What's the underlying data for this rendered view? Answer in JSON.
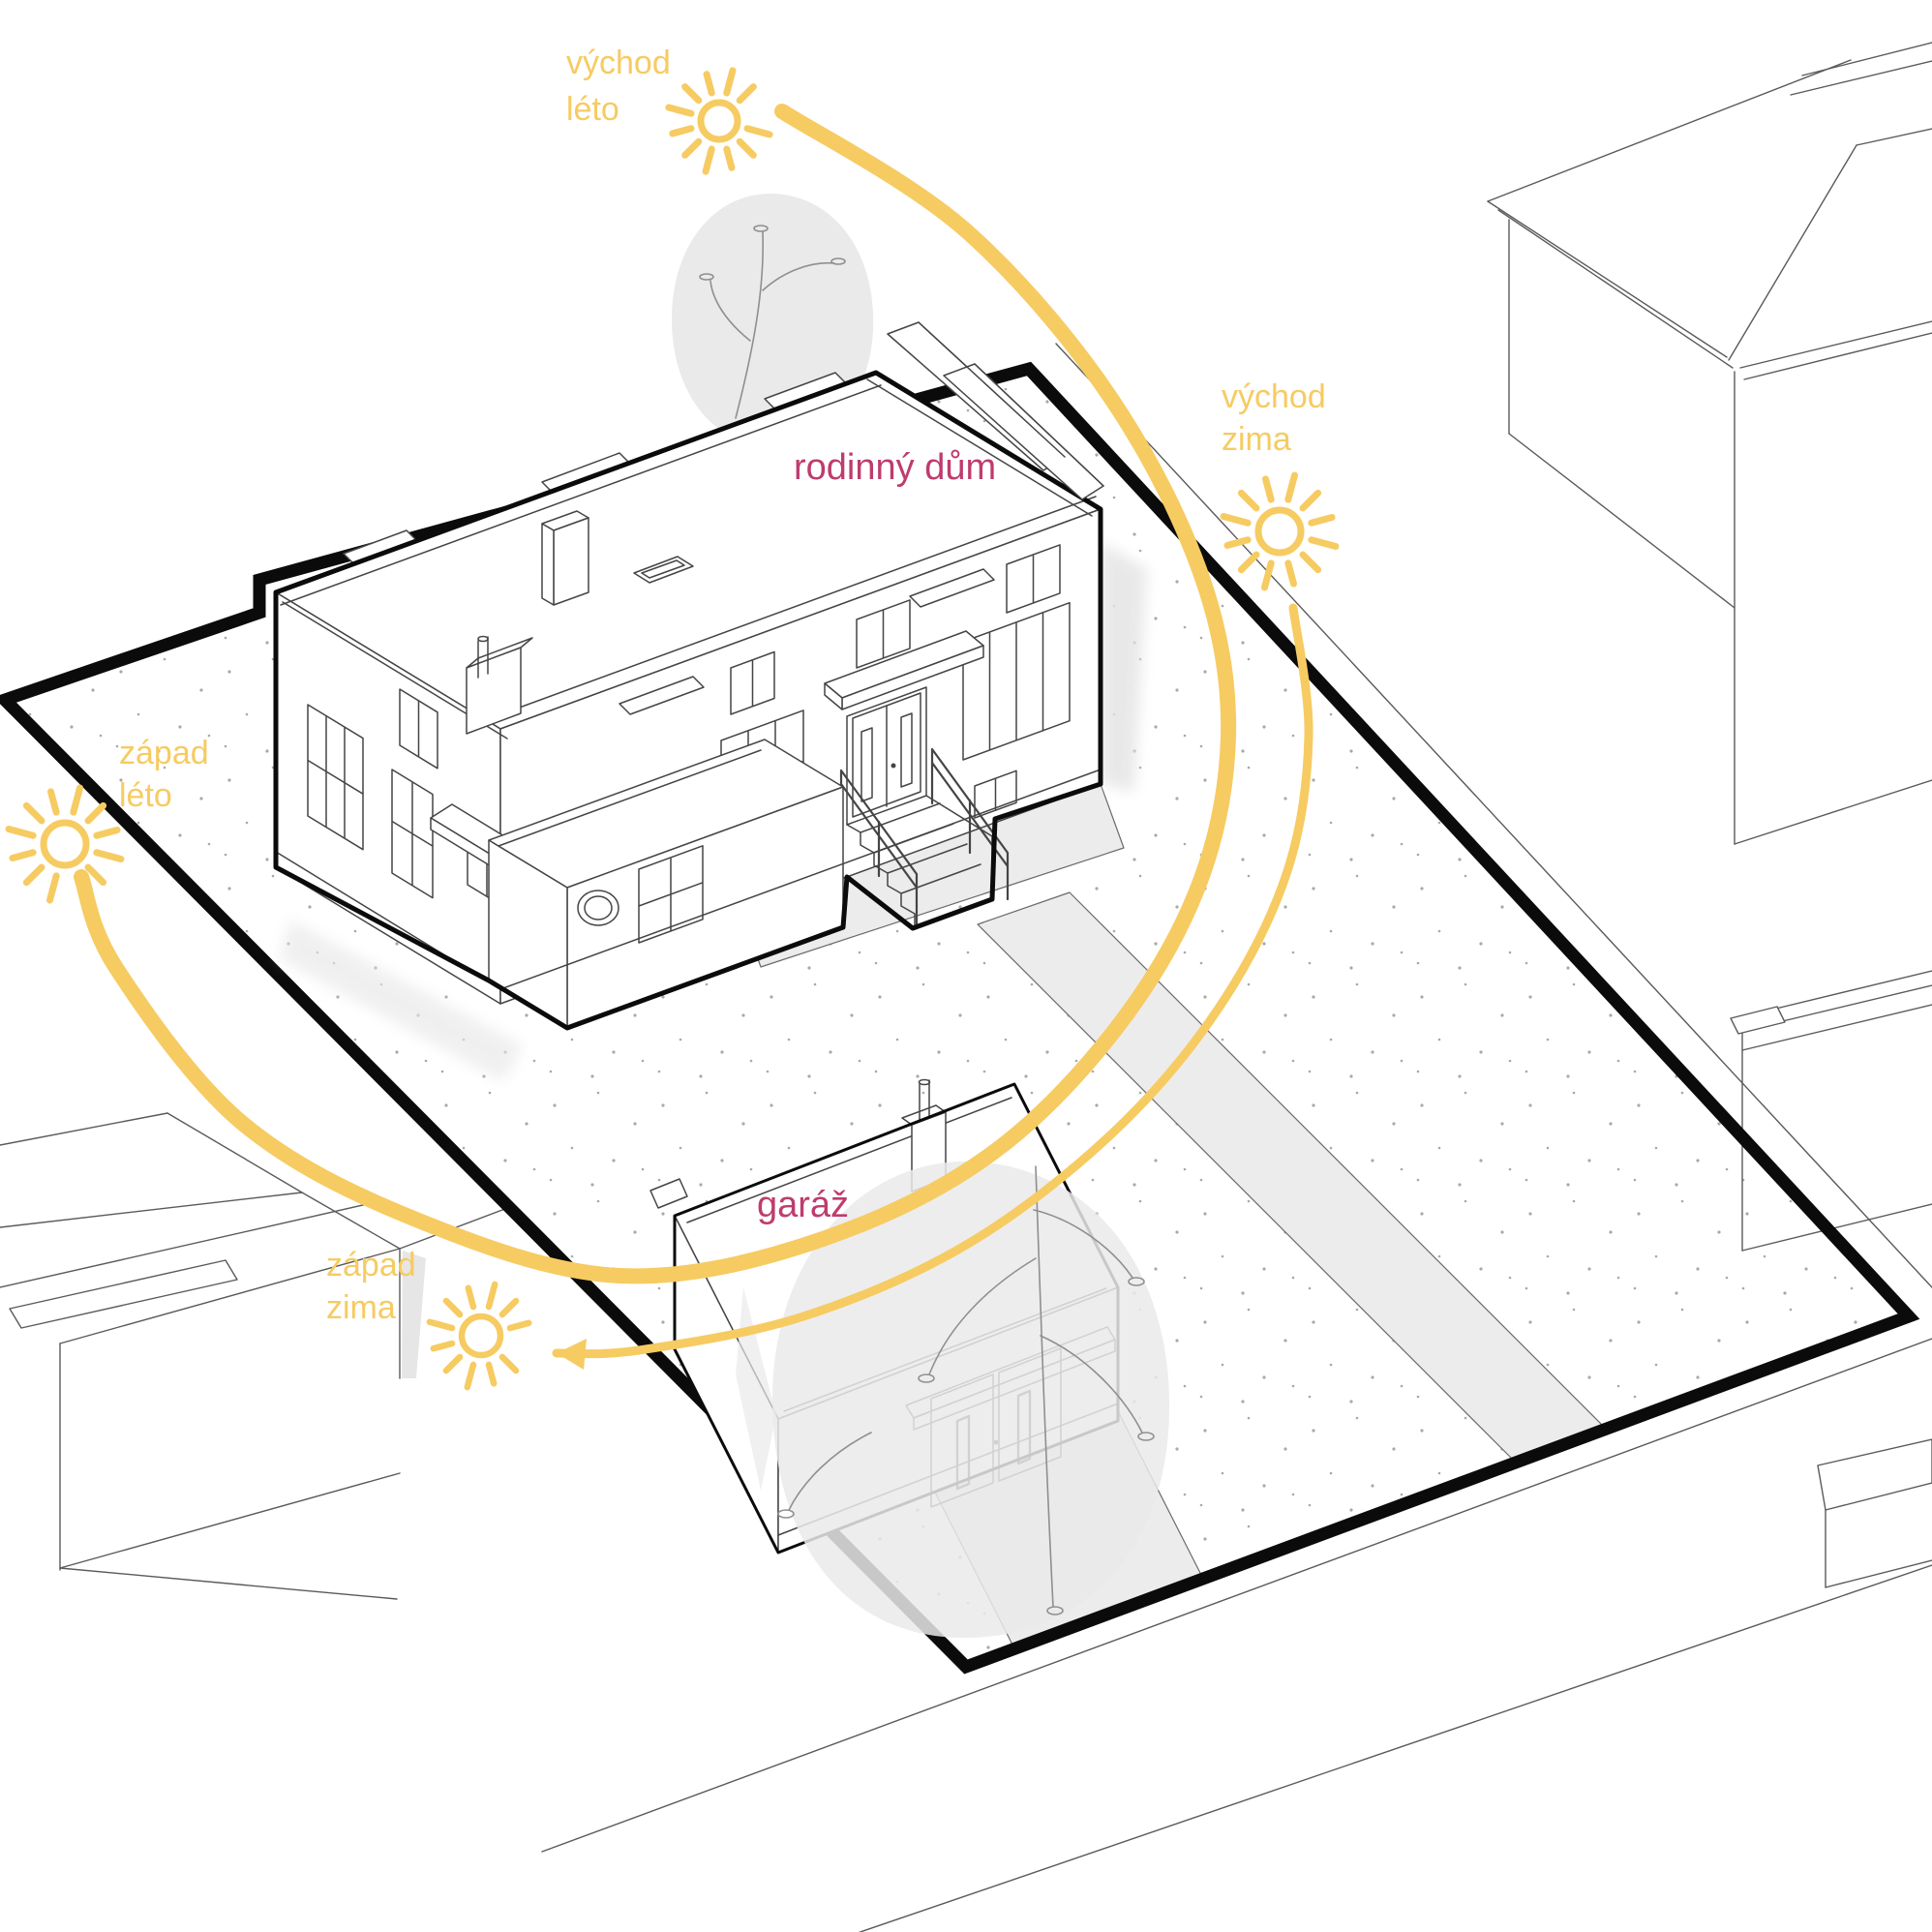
{
  "diagram": {
    "type": "site sun-path diagram",
    "labels": {
      "house": "rodinný dům",
      "garage": "garáž"
    },
    "sun_positions": [
      {
        "id": "east-summer",
        "line1": "východ",
        "line2": "léto"
      },
      {
        "id": "east-winter",
        "line1": "východ",
        "line2": "zima"
      },
      {
        "id": "west-summer",
        "line1": "západ",
        "line2": "léto"
      },
      {
        "id": "west-winter",
        "line1": "západ",
        "line2": "zima"
      }
    ]
  },
  "colors": {
    "sun_yellow": "#F6CB62",
    "label_magenta": "#BE3C6E",
    "outline_black": "#0B0B0B",
    "line_gray": "#454545",
    "neighbor_gray": "#5A5A5A",
    "paving_gray": "#ECECEC",
    "foliage_gray": "#EAEAEA",
    "stipple_gray": "#A9A9A9",
    "background": "#FFFFFF"
  }
}
